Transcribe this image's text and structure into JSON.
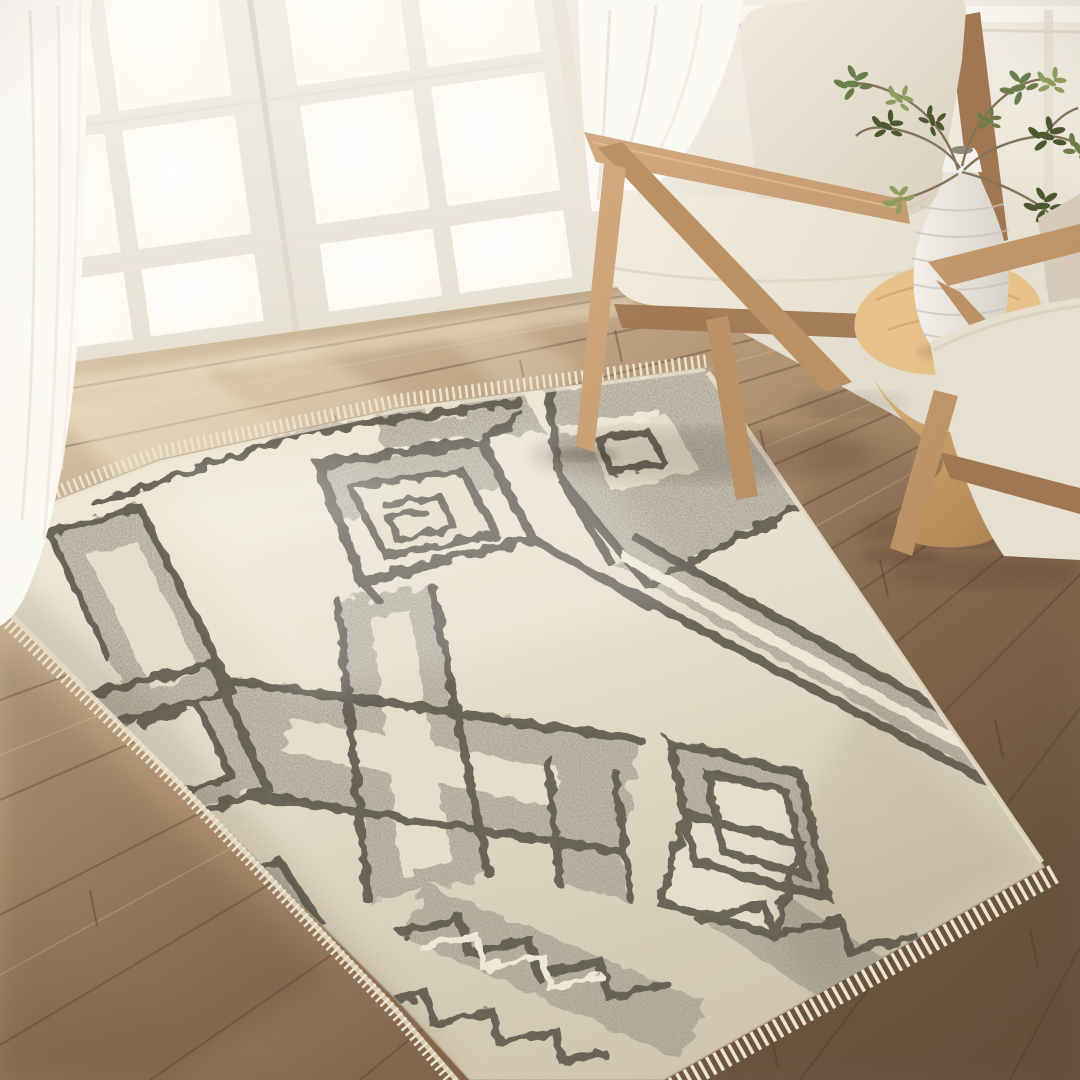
{
  "meta": {
    "title": "Sunlit living room corner with geometric area rug",
    "alt": "High-angle photograph of an ivory and charcoal-gray geometric fringe rug on warm oak plank flooring, beside white french doors with sheer curtains, two light-oak mid-century armchairs with ivory cushions, and a carved wood hourglass side table holding a white ribbed vase of green branches."
  },
  "palette": {
    "wall": "#f4efe6",
    "wall_shade": "#e3dccd",
    "door_frame": "#f8f6f0",
    "door_shade": "#e6e0d4",
    "pane": "#ffffff",
    "pane_warm": "#fdf7ec",
    "curtain": "#fbf9f4",
    "curtain_fold": "#e5ded1",
    "floor_light": "#d9c6a9",
    "floor_mid": "#b29472",
    "floor_dark": "#86684d",
    "floor_deep": "#6e5741",
    "plank_line": "#4a3523",
    "plank_light": "#eedfc4",
    "sunbeam": "#f9ecd2",
    "rug_sunlit": "#f4eedb",
    "rug_ivory": "#e9e1cd",
    "rug_shade": "#d2c8b1",
    "rug_gray": "#a19c8f",
    "rug_dark": "#5f5a4f",
    "rug_ivory_line": "#f1ebda",
    "rug_fringe": "#ece4d0",
    "oak_light": "#d3ab81",
    "oak_mid": "#bb9166",
    "oak_dark": "#9f7852",
    "cushion_light": "#f2ecdf",
    "cushion_mid": "#e7dfcf",
    "cushion_shadow": "#d5cbb8",
    "table_light": "#e3bb82",
    "table_dark": "#aa7e4b",
    "table_top": "#e8c389",
    "vase_light": "#f2f0ea",
    "vase_shade": "#d6d2c7",
    "vase_rib": "#c7c3b7",
    "leaf_dark": "#4b5830",
    "leaf_mid": "#6b7d48",
    "leaf_light": "#8e9e5e",
    "branch": "#84735a",
    "shadow": "#302416"
  },
  "scene": {
    "objects": [
      {
        "id": "wall",
        "label": "Warm white paneled wall"
      },
      {
        "id": "french-doors",
        "label": "White french doors with sunlit glass panes"
      },
      {
        "id": "curtain-center",
        "label": "Sheer white curtain panel by the doors"
      },
      {
        "id": "wood-floor",
        "label": "Warm oak plank hardwood floor"
      },
      {
        "id": "sunlight",
        "label": "Sunlight pooling on the floor"
      },
      {
        "id": "area-rug",
        "label": "Ivory and charcoal geometric area rug with fringe"
      },
      {
        "id": "curtain-left",
        "label": "Sheer white curtain at left edge"
      },
      {
        "id": "floor-shadows",
        "label": "Soft furniture shadows"
      },
      {
        "id": "armchair-main",
        "label": "Mid-century oak Z-frame armchair with ivory cushions"
      },
      {
        "id": "side-table",
        "label": "Carved wood hourglass side table"
      },
      {
        "id": "vase",
        "label": "White ribbed bottle vase"
      },
      {
        "id": "plant",
        "label": "Green leafy branches in the vase"
      },
      {
        "id": "armchair-right",
        "label": "Second oak armchair, partially in frame"
      }
    ]
  }
}
